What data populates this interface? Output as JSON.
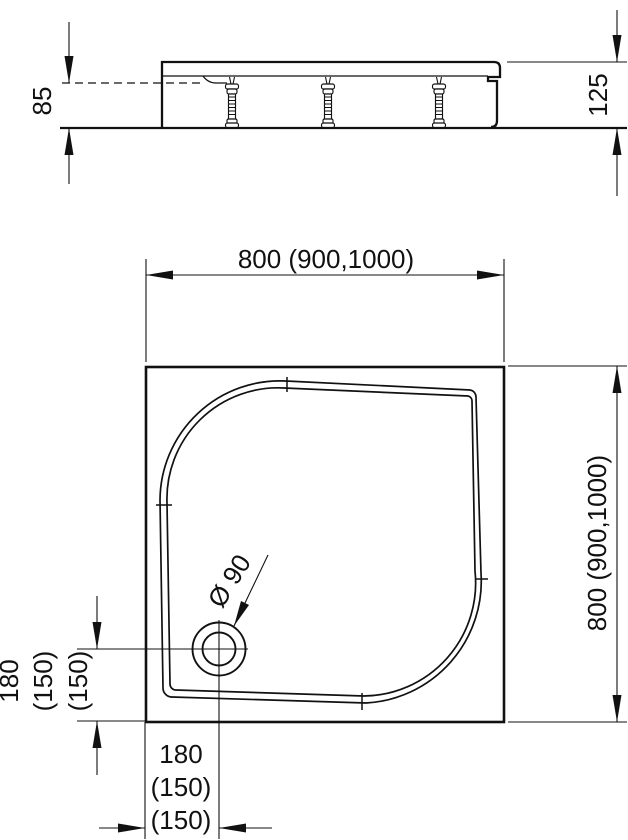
{
  "side_view": {
    "height_label": "125",
    "depth_label": "85"
  },
  "plan_view": {
    "width_label": "800 (900,1000)",
    "height_label": "800 (900,1000)",
    "drain_label": "Ø 90",
    "offset_left": {
      "l1": "180",
      "l2": "(150)",
      "l3": "(150)"
    },
    "offset_bottom": {
      "l1": "180",
      "l2": "(150)",
      "l3": "(150)"
    }
  },
  "colors": {
    "line": "#111111",
    "background": "#ffffff"
  }
}
